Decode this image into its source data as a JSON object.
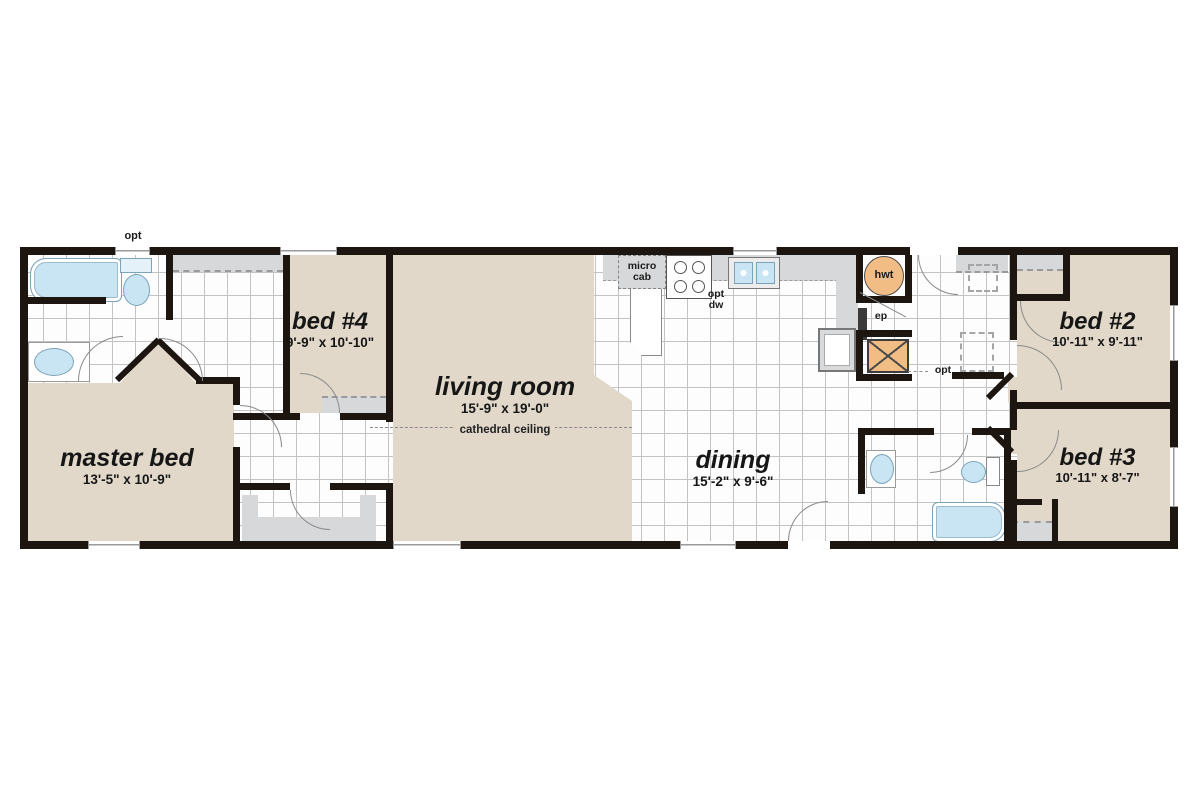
{
  "plan_title": "single-wide home floor plan",
  "rooms": {
    "master": {
      "name": "master bed",
      "dims": "13'-5\"  x  10'-9\""
    },
    "bed4": {
      "name": "bed #4",
      "dims": "9'-9\"  x  10'-10\""
    },
    "living": {
      "name": "living room",
      "dims": "15'-9\"  x  19'-0\"",
      "note": "cathedral ceiling"
    },
    "dining": {
      "name": "dining",
      "dims": "15'-2\"  x  9'-6\""
    },
    "bed2": {
      "name": "bed #2",
      "dims": "10'-11\"  x  9'-11\""
    },
    "bed3": {
      "name": "bed #3",
      "dims": "10'-11\"  x  8'-7\""
    }
  },
  "labels": {
    "opt_window": "opt",
    "micro": "micro",
    "cab": "cab",
    "opt": "opt",
    "dw": "dw",
    "hwt": "hwt",
    "ep": "ep",
    "opt_washer": "opt"
  },
  "colors": {
    "carpet": "#e1d8c9",
    "fixture_blue": "#c9e4f3",
    "accent_orange": "#f2bd84",
    "wall": "#1c1510",
    "counter_gray": "#d7d8d9"
  }
}
